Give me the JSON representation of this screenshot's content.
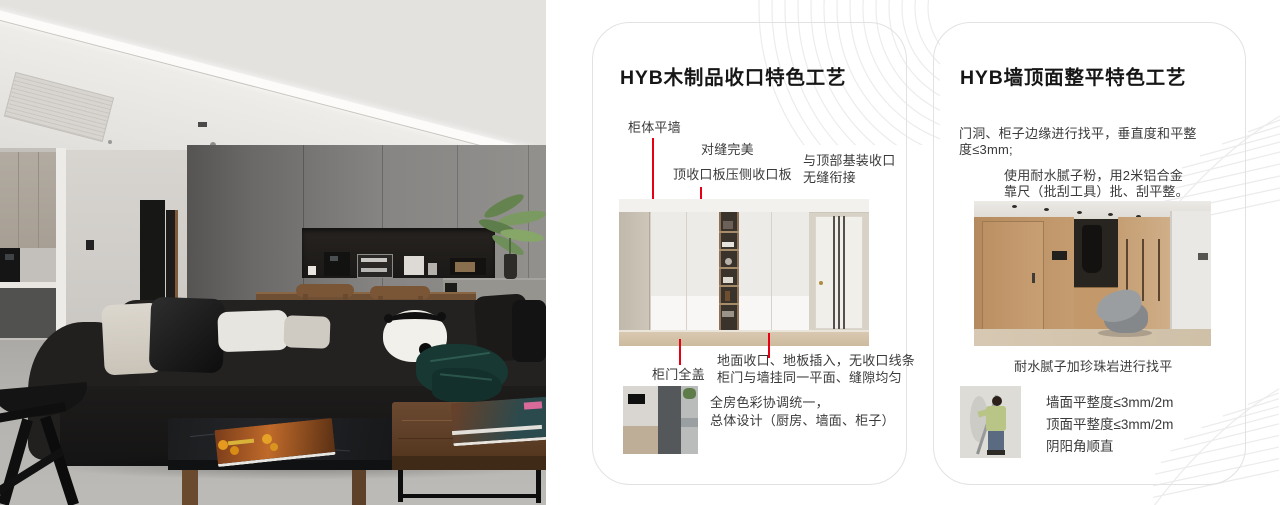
{
  "colors": {
    "accent_red": "#e60012",
    "card_border": "#e2e2e2",
    "page_bg": "#ffffff",
    "title_text": "#161616",
    "body_text": "#3a3a3a",
    "decor_line": "#ececec"
  },
  "card1": {
    "title": "HYB木制品收口特色工艺",
    "callout_cabinet_wall": "柜体平墙",
    "callout_seam": "对缝完美",
    "callout_top_strip": "顶收口板压侧收口板",
    "callout_ceiling_1": "与顶部基装收口",
    "callout_ceiling_2": "无缝衔接",
    "callout_door_cover": "柜门全盖",
    "callout_floor_1": "地面收口、地板插入，无收口线条",
    "callout_floor_2": "柜门与墙挂同一平面、缝隙均匀",
    "note_1": "全房色彩协调统一，",
    "note_2": "总体设计（厨房、墙面、柜子）"
  },
  "card2": {
    "title": "HYB墙顶面整平特色工艺",
    "para1_1": "门洞、柜子边缘进行找平，垂直度和平整",
    "para1_2": "度≤3mm;",
    "para2_1": "使用耐水腻子粉，用2米铝合金",
    "para2_2": "靠尺（批刮工具）批、刮平整。",
    "caption": "耐水腻子加珍珠岩进行找平",
    "spec_1": "墙面平整度≤3mm/2m",
    "spec_2": "顶面平整度≤3mm/2m",
    "spec_3": "阴阳角顺直"
  }
}
